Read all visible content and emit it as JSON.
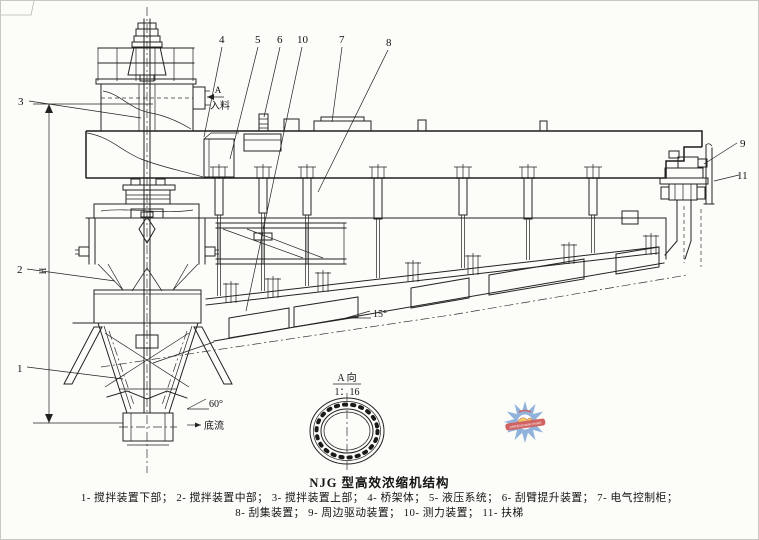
{
  "figure": {
    "caption_title": "NJG 型高效浓缩机结构",
    "caption_line1": "1- 搅拌装置下部；  2- 搅拌装置中部；  3- 搅拌装置上部；  4- 桥架体；  5- 液压系统；  6- 刮臂提升装置；  7- 电气控制柜；",
    "caption_line2": "8- 刮集装置；  9- 周边驱动装置；  10- 测力装置；  11- 扶梯"
  },
  "callouts": {
    "c1": "1",
    "c2": "2",
    "c3": "3",
    "c4": "4",
    "c5": "5",
    "c6": "6",
    "c7": "7",
    "c8": "8",
    "c9": "9",
    "c10": "10",
    "c11": "11"
  },
  "annotations": {
    "feed_view_letter": "A",
    "feed_label": "入料",
    "bottom_slope": "15°",
    "cone_angle": "60°",
    "underflow_label": "底流",
    "detail_view_label": "A 向",
    "detail_view_scale": "1：16",
    "height_dim_label": "H"
  },
  "watermark": {
    "banner_text": "JINPENGMACHINE"
  },
  "colors": {
    "line": "#222222",
    "paper": "#fcfcf9",
    "watermark_blue": "#7fa7d6",
    "watermark_yellow": "#f0c34a",
    "watermark_red": "#c94848"
  }
}
